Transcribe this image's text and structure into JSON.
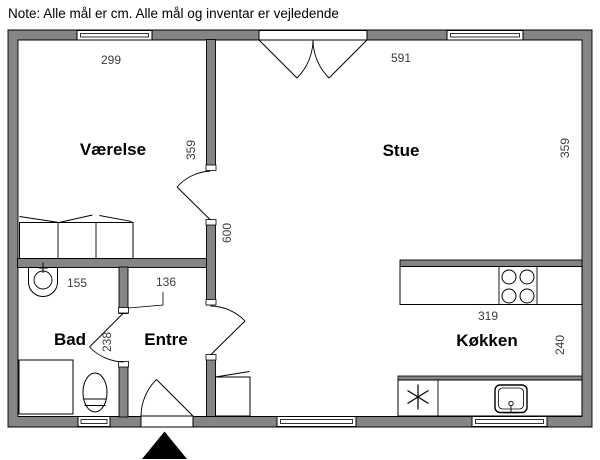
{
  "note": "Note: Alle mål er cm. Alle mål og inventar er vejledende",
  "floorplan": {
    "rooms": {
      "vaerelse": {
        "label": "Værelse"
      },
      "stue": {
        "label": "Stue"
      },
      "bad": {
        "label": "Bad"
      },
      "entre": {
        "label": "Entre"
      },
      "koekken": {
        "label": "Køkken"
      }
    },
    "dims": {
      "vaerelse_width": "299",
      "vaerelse_depth": "359",
      "stue_width": "591",
      "stue_depth": "359",
      "total_depth": "600",
      "bad_width": "155",
      "entre_width": "136",
      "bad_clearance": "238",
      "koekken_width": "319",
      "koekken_depth": "240"
    },
    "colors": {
      "wall": "#858585",
      "arrow": "#000000"
    }
  }
}
